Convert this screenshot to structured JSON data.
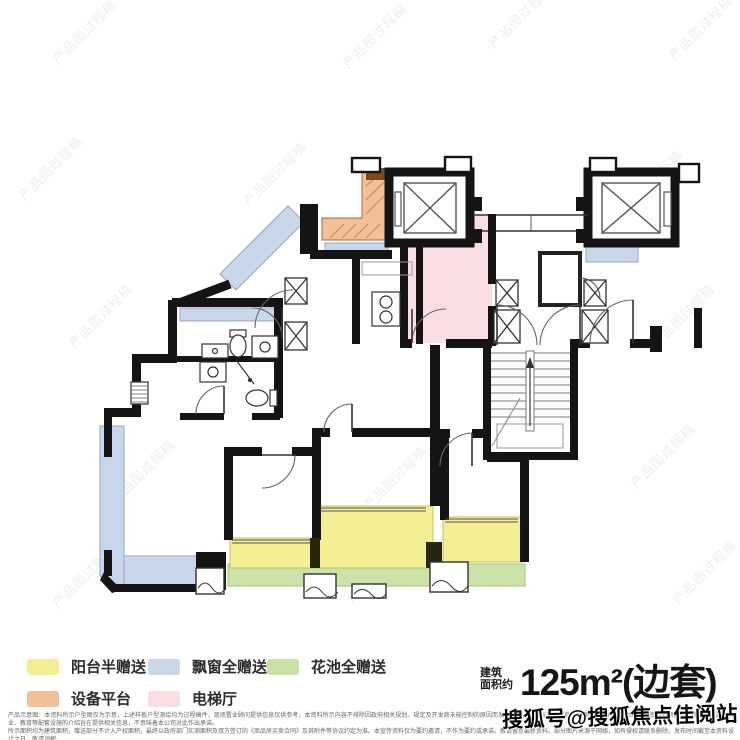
{
  "watermark": {
    "tile_text": "产品图过程稿"
  },
  "legend": {
    "items": [
      {
        "label": "阳台半赠送",
        "color": "#f4ef93"
      },
      {
        "label": "飘窗全赠送",
        "color": "#c9d7eb"
      },
      {
        "label": "花池全赠送",
        "color": "#c8e2a5"
      },
      {
        "label": "设备平台",
        "color": "#f3bf97"
      },
      {
        "label": "电梯厅",
        "color": "#f9dee4"
      }
    ]
  },
  "area": {
    "label_stacked": "建筑\n面积约",
    "value": "125m²(边套)"
  },
  "footer": {
    "disclaimer_line1": "产品示意图：本资料所示户型图仅为示意，上述样板户型测绘均为过程稿件，现场置业顾问提供信息仅供参考，本资料所示内容不排除因政府相关规划、规定及开发商未能控制的原因而发生变化，交付标准以《商品房预售合同》约定为准；本资料对项目周边环境、交通、商业、教育等配套设施的介绍旨在提供相关信息，不意味着本公司对此作出承诺。",
    "disclaimer_line2": "所示面积均为建筑面积，赠送部分不计入产权面积，最终以政府部门实测面积及双方签订的《商品房买卖合同》及其附件等协议约定为准。本宣传资料仅为要约邀请，不作为要约或承诺。敬请留意最新资料。部分图片来源于网络，如有侵权请联系删除。发布时间截至本资料设计之日，敬请谅解。"
  },
  "source_watermark": {
    "text": "搜狐号@搜狐焦点佳阅站"
  }
}
